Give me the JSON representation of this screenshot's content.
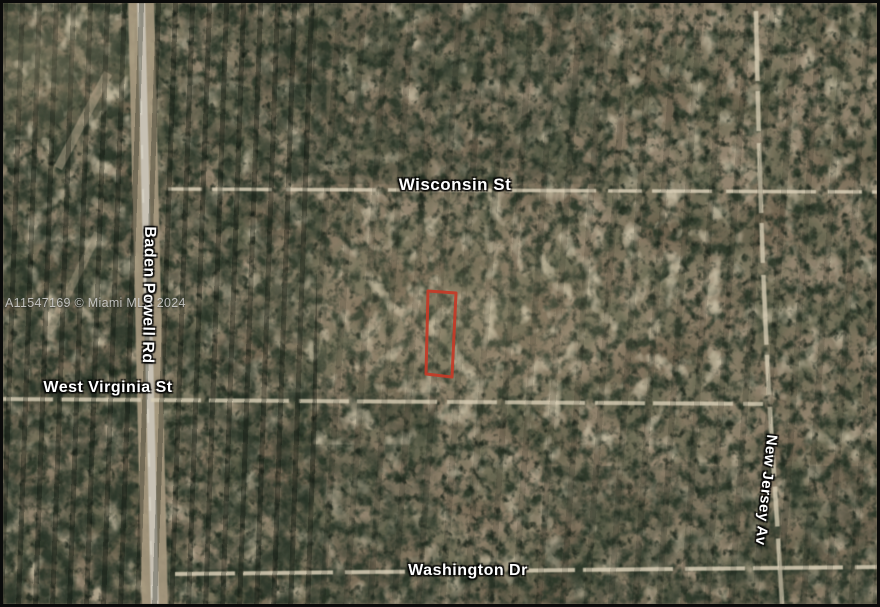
{
  "map": {
    "type": "satellite-parcel-map",
    "watermark": "A11547169 © Miami MLS 2024",
    "streets": [
      {
        "name": "Wisconsin St",
        "orientation": "horizontal"
      },
      {
        "name": "West Virginia St",
        "orientation": "horizontal"
      },
      {
        "name": "Washington Dr",
        "orientation": "horizontal"
      },
      {
        "name": "Baden Powell Rd",
        "orientation": "vertical"
      },
      {
        "name": "New Jersey Av",
        "orientation": "vertical"
      }
    ],
    "parcel": {
      "label": "subject-parcel-outline",
      "outline_color": "#c43b28"
    },
    "colors": {
      "terrain_base": "#8b7d68",
      "tree_dark": "#2e3b2c",
      "road_pavement": "#c2bcae",
      "road_shoulder": "#ab9d80",
      "trail_sand": "#d8ceb4",
      "label_text": "#ffffff",
      "frame": "#0a0a0a"
    }
  }
}
